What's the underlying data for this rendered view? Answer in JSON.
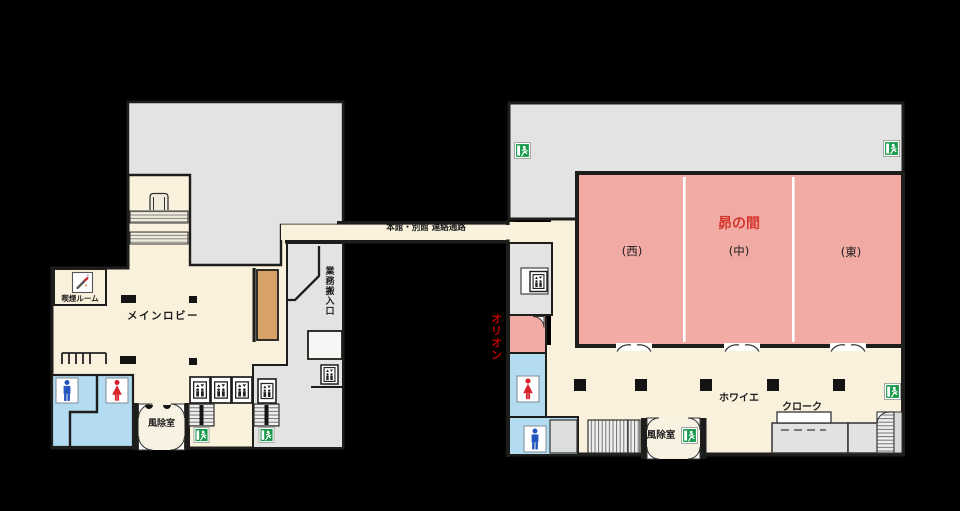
{
  "floorplan": {
    "main_building": {
      "lobby": "メインロビー",
      "smoking_room": "喫煙ルーム",
      "reception_col1": "フロント",
      "reception_col2": "レセプション",
      "service_entrance": "業務搬入口",
      "windbreak_room": "風除室"
    },
    "corridor": {
      "label": "本館・別館 連絡通路"
    },
    "annex": {
      "hall": "昴の間",
      "hall_section_west": "(西)",
      "hall_section_center": "(中)",
      "hall_section_east": "(東)",
      "small_hall": "オリオン",
      "foyer": "ホワイエ",
      "cloakroom": "クローク",
      "windbreak_room": "風除室"
    },
    "colors": {
      "floor_cream": "#faf1dd",
      "back_area_gray": "#e3e3e2",
      "hall_pink": "#f2aaa4",
      "toilet_blue": "#b3dcf1",
      "reception_brown": "#d7a268",
      "exit_sign_green": "#189a4a",
      "hall_label_red": "#d4372c",
      "orion_label_red": "#c00000",
      "male_icon_blue": "#2456c0",
      "female_icon_red": "#d8232a"
    }
  }
}
